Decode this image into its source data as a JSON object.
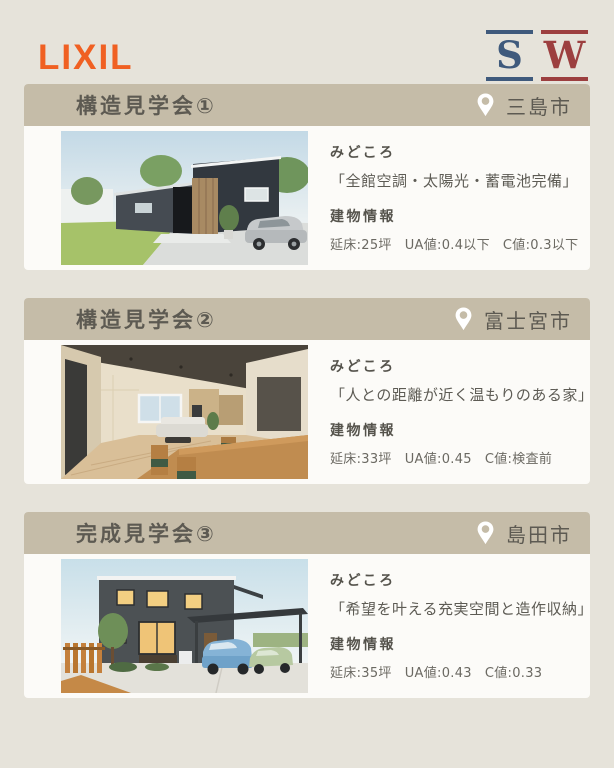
{
  "brand": {
    "lixil": "LIXIL",
    "sw": {
      "s": "S",
      "w": "W",
      "subtitle": "SUPER WALL"
    }
  },
  "colors": {
    "page_bg": "#e6e3da",
    "lixil_orange": "#f06022",
    "sw_blue": "#3f5a7c",
    "sw_red": "#9c3f3f",
    "card_header_tan": "#c5bca8",
    "card_bg": "#fcfbf8",
    "text_dark": "#5c5951",
    "pin_white": "#ffffff"
  },
  "cards": [
    {
      "title": "構造見学会①",
      "city": "三島市",
      "photo": "black-one-story-house-exterior",
      "highlight_label": "みどころ",
      "highlight": "「全館空調・太陽光・蓄電池完備」",
      "info_label": "建物情報",
      "specs": {
        "floor": "延床:25坪",
        "ua": "UA値:0.4以下",
        "c": "C値:0.3以下"
      }
    },
    {
      "title": "構造見学会②",
      "city": "富士宮市",
      "photo": "living-dining-interior",
      "highlight_label": "みどころ",
      "highlight": "「人との距離が近く温もりのある家」",
      "info_label": "建物情報",
      "specs": {
        "floor": "延床:33坪",
        "ua": "UA値:0.45",
        "c": "C値:検査前"
      }
    },
    {
      "title": "完成見学会③",
      "city": "島田市",
      "photo": "two-story-house-with-carport",
      "highlight_label": "みどころ",
      "highlight": "「希望を叶える充実空間と造作収納」",
      "info_label": "建物情報",
      "specs": {
        "floor": "延床:35坪",
        "ua": "UA値:0.43",
        "c": "C値:0.33"
      }
    }
  ]
}
